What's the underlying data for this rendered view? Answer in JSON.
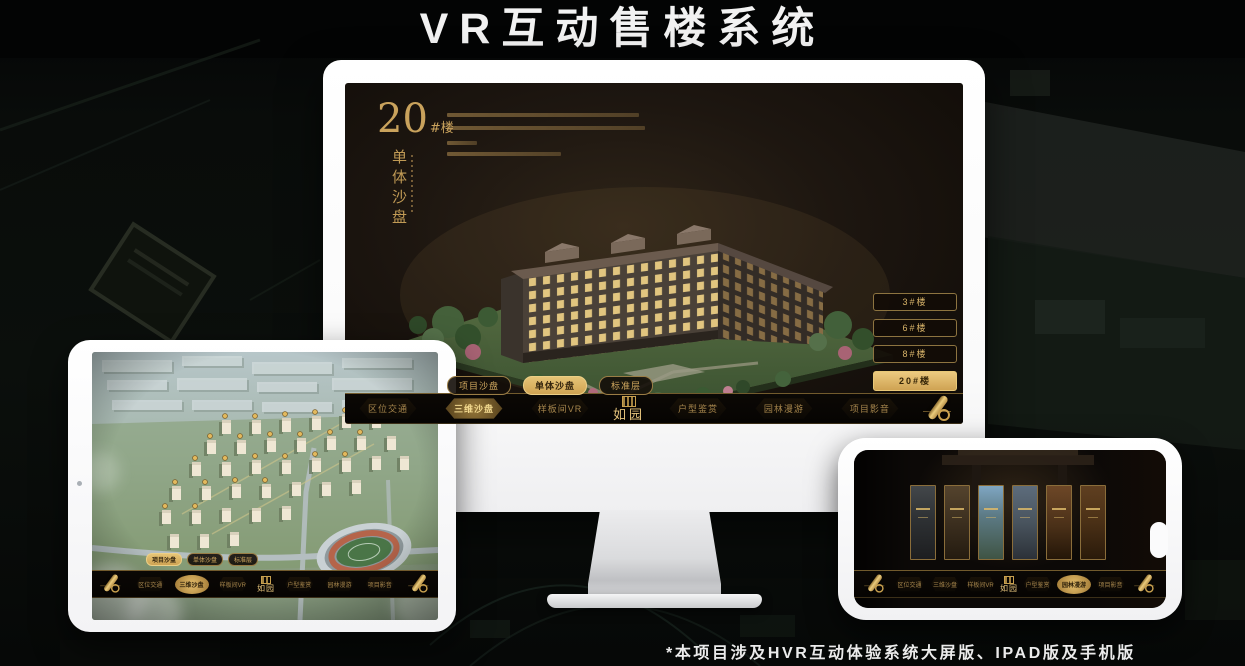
{
  "page": {
    "title": "VR互动售楼系统",
    "footnote": "*本项目涉及HVR互动体验系统大屏版、IPAD版及手机版"
  },
  "colors": {
    "accent_gold": "#d5ae66",
    "gold_bright": "#ecca80",
    "active_tab_bg": "#ddb667",
    "screen_bg": "#1d1610",
    "device_white": "#fbfbfc"
  },
  "screen": {
    "headline": {
      "number": "20",
      "suffix": "#楼",
      "vertical": "单体沙盘"
    },
    "floor_buttons": [
      {
        "label": "3#楼",
        "active": false
      },
      {
        "label": "6#楼",
        "active": false
      },
      {
        "label": "8#楼",
        "active": false
      },
      {
        "label": "20#楼",
        "active": true
      }
    ],
    "sub_tabs": [
      {
        "label": "项目沙盘",
        "active": false
      },
      {
        "label": "单体沙盘",
        "active": true
      },
      {
        "label": "标准层",
        "active": false
      }
    ],
    "nav": {
      "logo": "如园",
      "items_left": [
        {
          "label": "区位交通",
          "active": false
        },
        {
          "label": "三维沙盘",
          "active": true
        },
        {
          "label": "样板间VR",
          "active": false
        }
      ],
      "items_right": [
        {
          "label": "户型鉴赏",
          "active": false
        },
        {
          "label": "园林漫游",
          "active": false
        },
        {
          "label": "项目影音",
          "active": false
        }
      ]
    }
  },
  "tablet": {
    "sub_tabs": [
      {
        "label": "项目沙盘",
        "active": true
      },
      {
        "label": "单体沙盘",
        "active": false
      },
      {
        "label": "标准层",
        "active": false
      }
    ],
    "nav": {
      "logo": "如园",
      "items_left": [
        {
          "label": "区位交通",
          "active": false
        },
        {
          "label": "三维沙盘",
          "active": true
        },
        {
          "label": "样板间VR",
          "active": false
        }
      ],
      "items_right": [
        {
          "label": "户型鉴赏",
          "active": false
        },
        {
          "label": "园林漫游",
          "active": false
        },
        {
          "label": "项目影音",
          "active": false
        }
      ]
    }
  },
  "phone": {
    "nav": {
      "logo": "如园",
      "items_left": [
        {
          "label": "区位交通",
          "active": false
        },
        {
          "label": "三维沙盘",
          "active": false
        },
        {
          "label": "样板间VR",
          "active": false
        }
      ],
      "items_right": [
        {
          "label": "户型鉴赏",
          "active": false
        },
        {
          "label": "园林漫游",
          "active": true
        },
        {
          "label": "项目影音",
          "active": false
        }
      ]
    }
  }
}
